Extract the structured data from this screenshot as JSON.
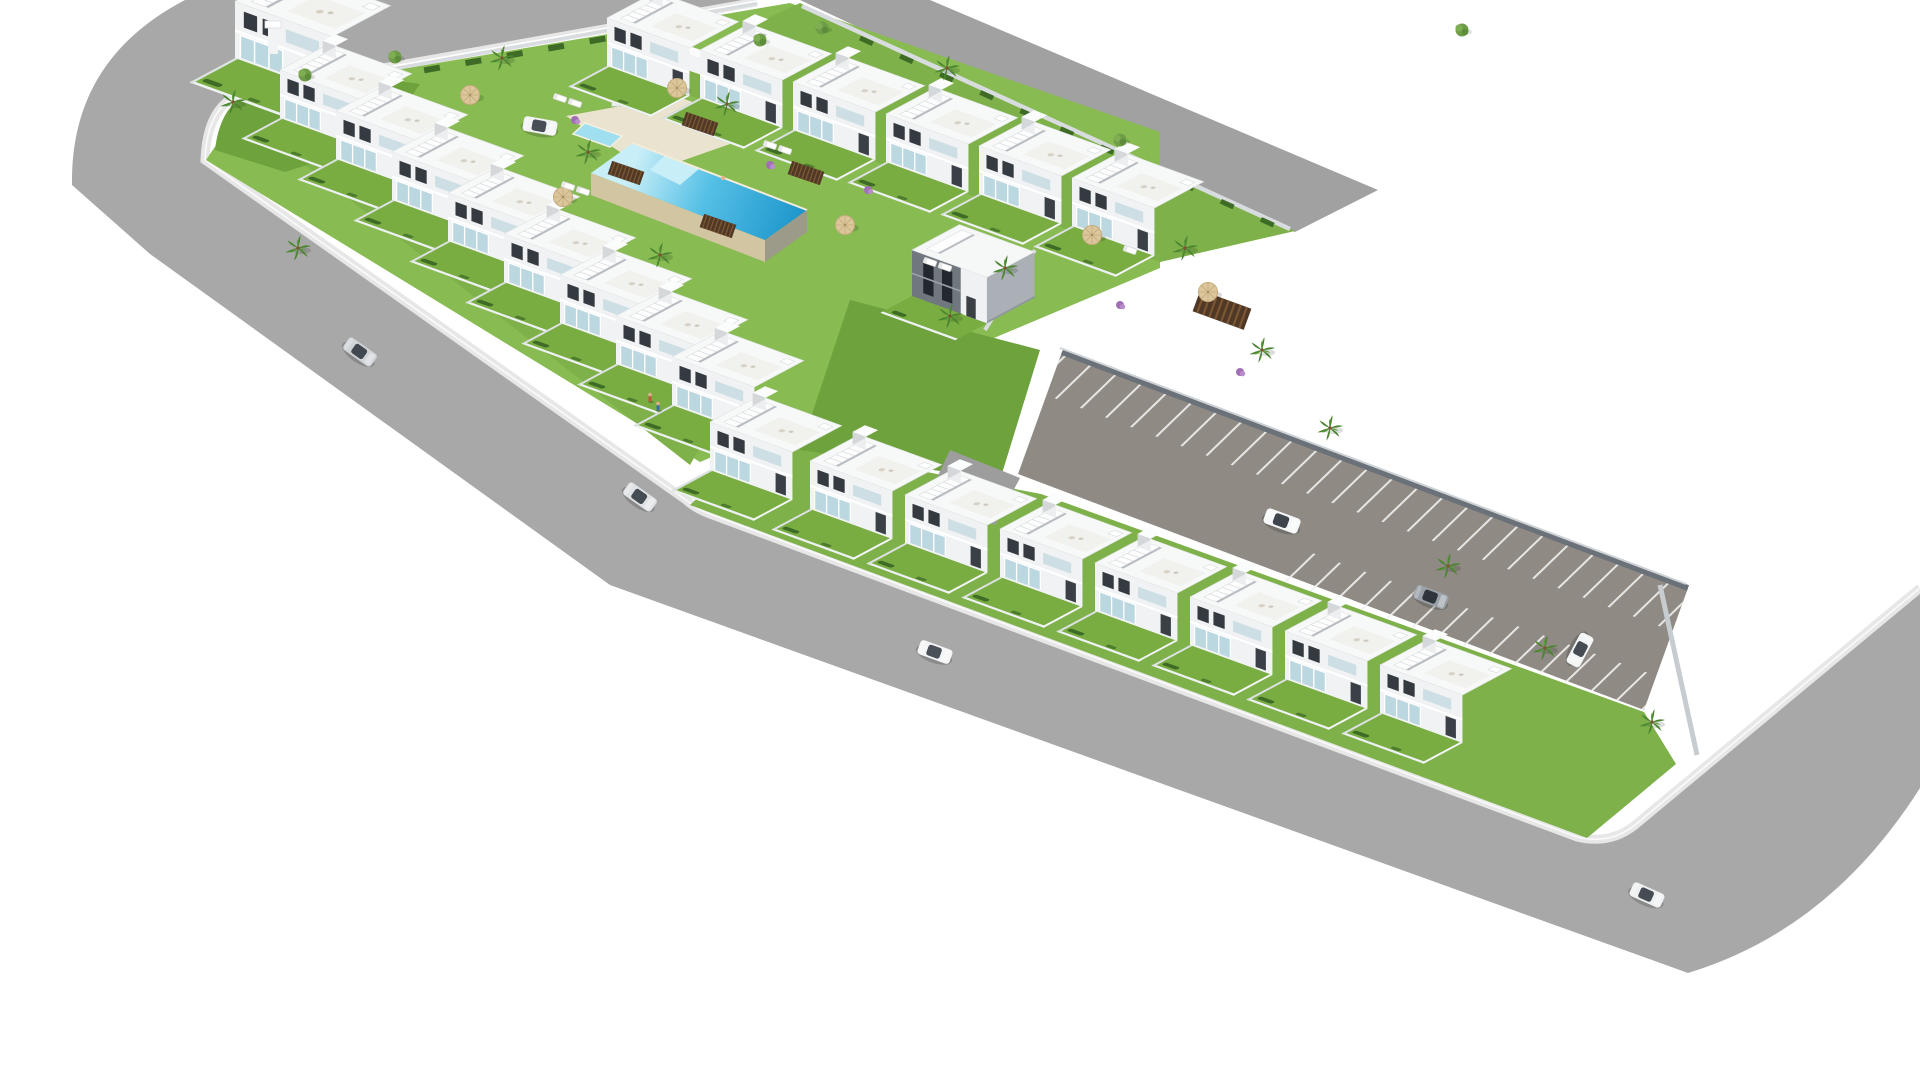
{
  "scene": {
    "type": "3d-architectural-aerial-render",
    "description": "Isometric aerial render of a new-build residential development: white two-storey townhouses with roof terraces and external stairs arranged around a central lawn courtyard with a large infinity pool and a kids pool, bordered by gray asphalt roads, a diagonal parking strip with marked stalls, palm trees, sun umbrellas, loungers and a few cars.",
    "background": "#ffffff"
  },
  "colors": {
    "road": "#a8a8a8",
    "road_top_right": "#a1a1a1",
    "parking_asphalt": "#8f8a84",
    "stall_line": "#f2f2f2",
    "sidewalk": "#e7e7e7",
    "curb": "#fafafa",
    "lawn": "#7eb14a",
    "lawn_bright": "#88bb52",
    "lawn_dark": "#6da23d",
    "hedge": "#3e6b26",
    "house_front": "#f1f2f3",
    "house_side": "#c6cbd0",
    "house_roof": "#f7f8f8",
    "window": "#343a40",
    "balcony_glass": "#aecfd9",
    "gray_house_front": "#70777f",
    "pool_deck": "#e9e3cf",
    "pool_wall": "#d2c5a2",
    "pool_wall_shade": "#9c9a88",
    "water_shallow": "#c8eef7",
    "water_deep": "#1f97cc",
    "kids_pool": "#9fdff0",
    "wood_deck": "#4f3825",
    "palm_frond": "#4b8530",
    "palm_trunk": "#7a5633",
    "wall_light": "#d8dcdf",
    "wall_dark": "#6b7178"
  },
  "counts": {
    "townhouses": 24,
    "cars": 8,
    "pools": 2,
    "palm_trees": 15,
    "round_trees": 6,
    "parking_spaces": 22,
    "umbrellas": 6,
    "sun_loungers": 9,
    "pedestrians": 2
  },
  "houses": {
    "upper_row": [
      {
        "t": "translate(607,66)"
      },
      {
        "t": "translate(700,98)"
      },
      {
        "t": "translate(793,130)"
      },
      {
        "t": "translate(886,162)"
      },
      {
        "t": "translate(979,194)"
      },
      {
        "t": "translate(1072,226)"
      }
    ],
    "left_wing": [
      {
        "t": "translate(280,118)"
      },
      {
        "t": "translate(336,159)"
      },
      {
        "t": "translate(392,200)"
      },
      {
        "t": "translate(448,241)"
      },
      {
        "t": "translate(504,282)"
      },
      {
        "t": "translate(560,323)"
      },
      {
        "t": "translate(616,364)"
      },
      {
        "t": "translate(672,405)"
      }
    ],
    "right_wing": [
      {
        "t": "translate(710,470)"
      },
      {
        "t": "translate(810,509)"
      },
      {
        "t": "translate(905,543)"
      },
      {
        "t": "translate(1000,577)"
      },
      {
        "t": "translate(1095,611)"
      },
      {
        "t": "translate(1190,645)"
      },
      {
        "t": "translate(1285,679)"
      },
      {
        "t": "translate(1380,713)"
      }
    ],
    "corner": {
      "t": "translate(235,58) scale(1.18)"
    },
    "gray": {
      "t": "translate(912,296)"
    }
  },
  "cars": [
    {
      "t": "translate(360,352) rotate(35)",
      "style": "--body:#cfd3d7;--glass:#41484f"
    },
    {
      "t": "translate(640,497) rotate(35)",
      "style": "--body:#dfe2e5;--glass:#454c53"
    },
    {
      "t": "translate(935,652) rotate(20)",
      "style": "--body:#f4f5f6;--glass:#4a5158"
    },
    {
      "t": "translate(1647,895) rotate(24)",
      "style": "--body:#eef0f1;--glass:#454c53"
    },
    {
      "t": "translate(540,126) rotate(10)",
      "style": "--body:#f2f3f4;--glass:#474e55"
    },
    {
      "t": "translate(1282,521) rotate(20) scale(1.06)",
      "style": "--body:#f6f7f8;--glass:#3e454c"
    },
    {
      "t": "translate(1431,597) rotate(21)",
      "style": "--body:#9aa1a8;--glass:#2f353b"
    },
    {
      "t": "translate(1580,650) rotate(118)",
      "style": "--body:#f2f4f5;--glass:#454c53"
    }
  ],
  "palms": [
    {
      "t": "translate(233,102)"
    },
    {
      "t": "translate(298,248)"
    },
    {
      "t": "translate(502,58)"
    },
    {
      "t": "translate(588,152)"
    },
    {
      "t": "translate(727,104)"
    },
    {
      "t": "translate(660,255)"
    },
    {
      "t": "translate(947,68)"
    },
    {
      "t": "translate(950,316)"
    },
    {
      "t": "translate(1005,268)"
    },
    {
      "t": "translate(1185,248)"
    },
    {
      "t": "translate(1262,350)"
    },
    {
      "t": "translate(1330,428)"
    },
    {
      "t": "translate(1448,566)"
    },
    {
      "t": "translate(1545,648)"
    },
    {
      "t": "translate(1652,722)"
    }
  ],
  "round_trees": [
    {
      "t": "translate(305,75)"
    },
    {
      "t": "translate(395,57)"
    },
    {
      "t": "translate(760,40)"
    },
    {
      "t": "translate(822,28)"
    },
    {
      "t": "translate(1462,30)"
    },
    {
      "t": "translate(1120,140)"
    }
  ],
  "bushes": [
    {
      "t": "translate(575,120)"
    },
    {
      "t": "translate(770,165)"
    },
    {
      "t": "translate(868,190)"
    },
    {
      "t": "translate(1120,305)"
    },
    {
      "t": "translate(1240,372)"
    }
  ],
  "umbrellas": [
    {
      "t": "translate(470,95)"
    },
    {
      "t": "translate(677,88)"
    },
    {
      "t": "translate(563,197)"
    },
    {
      "t": "translate(845,225)"
    },
    {
      "t": "translate(1092,235)"
    },
    {
      "t": "translate(1208,292)"
    }
  ],
  "loungers": [
    {
      "t": "translate(560,98) rotate(19)"
    },
    {
      "t": "translate(575,103) rotate(19)"
    },
    {
      "t": "translate(568,186) rotate(19)"
    },
    {
      "t": "translate(583,191) rotate(19)"
    },
    {
      "t": "translate(770,145) rotate(19)"
    },
    {
      "t": "translate(785,150) rotate(19)"
    },
    {
      "t": "translate(930,262) rotate(19)"
    },
    {
      "t": "translate(945,267) rotate(19)"
    },
    {
      "t": "translate(1130,250) rotate(19)"
    }
  ],
  "wood_decks": [
    {
      "t": "translate(700,124) rotate(19)"
    },
    {
      "t": "translate(626,173) rotate(19)"
    },
    {
      "t": "translate(806,173) rotate(19)"
    },
    {
      "t": "translate(718,226) rotate(19)"
    },
    {
      "t": "translate(1222,310) rotate(20) scale(1.6)"
    }
  ],
  "figures": [
    {
      "t": "translate(650,400)",
      "style": "--shirt:#c2563a"
    },
    {
      "t": "translate(658,409)",
      "style": "--shirt:#3a6ea5"
    }
  ]
}
